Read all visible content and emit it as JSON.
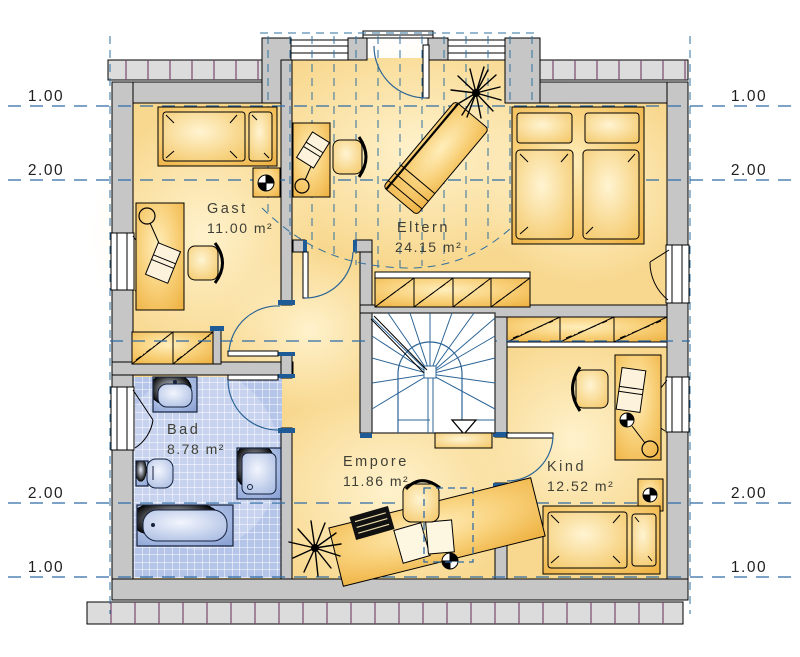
{
  "plan": {
    "title": "Dachgeschoss Grundriss",
    "rooms": {
      "gast": {
        "name": "Gast",
        "area": "11.00 m²"
      },
      "eltern": {
        "name": "Eltern",
        "area": "24.15 m²"
      },
      "bad": {
        "name": "Bad",
        "area": "8.78 m²"
      },
      "empore": {
        "name": "Empore",
        "area": "11.86 m²"
      },
      "kind": {
        "name": "Kind",
        "area": "12.52 m²"
      }
    },
    "dimension_marks": {
      "left": [
        "1.00",
        "2.00",
        "2.00",
        "1.00"
      ],
      "right": [
        "1.00",
        "2.00",
        "2.00",
        "1.00"
      ]
    },
    "colors": {
      "floor": "#f8d88f",
      "floor_glow": "#fff3cf",
      "wall": "#c6c6c6",
      "wall_outline": "#000000",
      "tile": "#b5c4e9",
      "fixture_blue": "#9db1dd",
      "dash_blue": "#2e6ba8",
      "stair_tread_blue": "#2c6496",
      "furniture_orange": "#f3bd55",
      "eave_tick_purple": "#7b4a6e",
      "label_text": "#3f3f36",
      "jamb_cap_blue": "#1d5a96"
    }
  }
}
